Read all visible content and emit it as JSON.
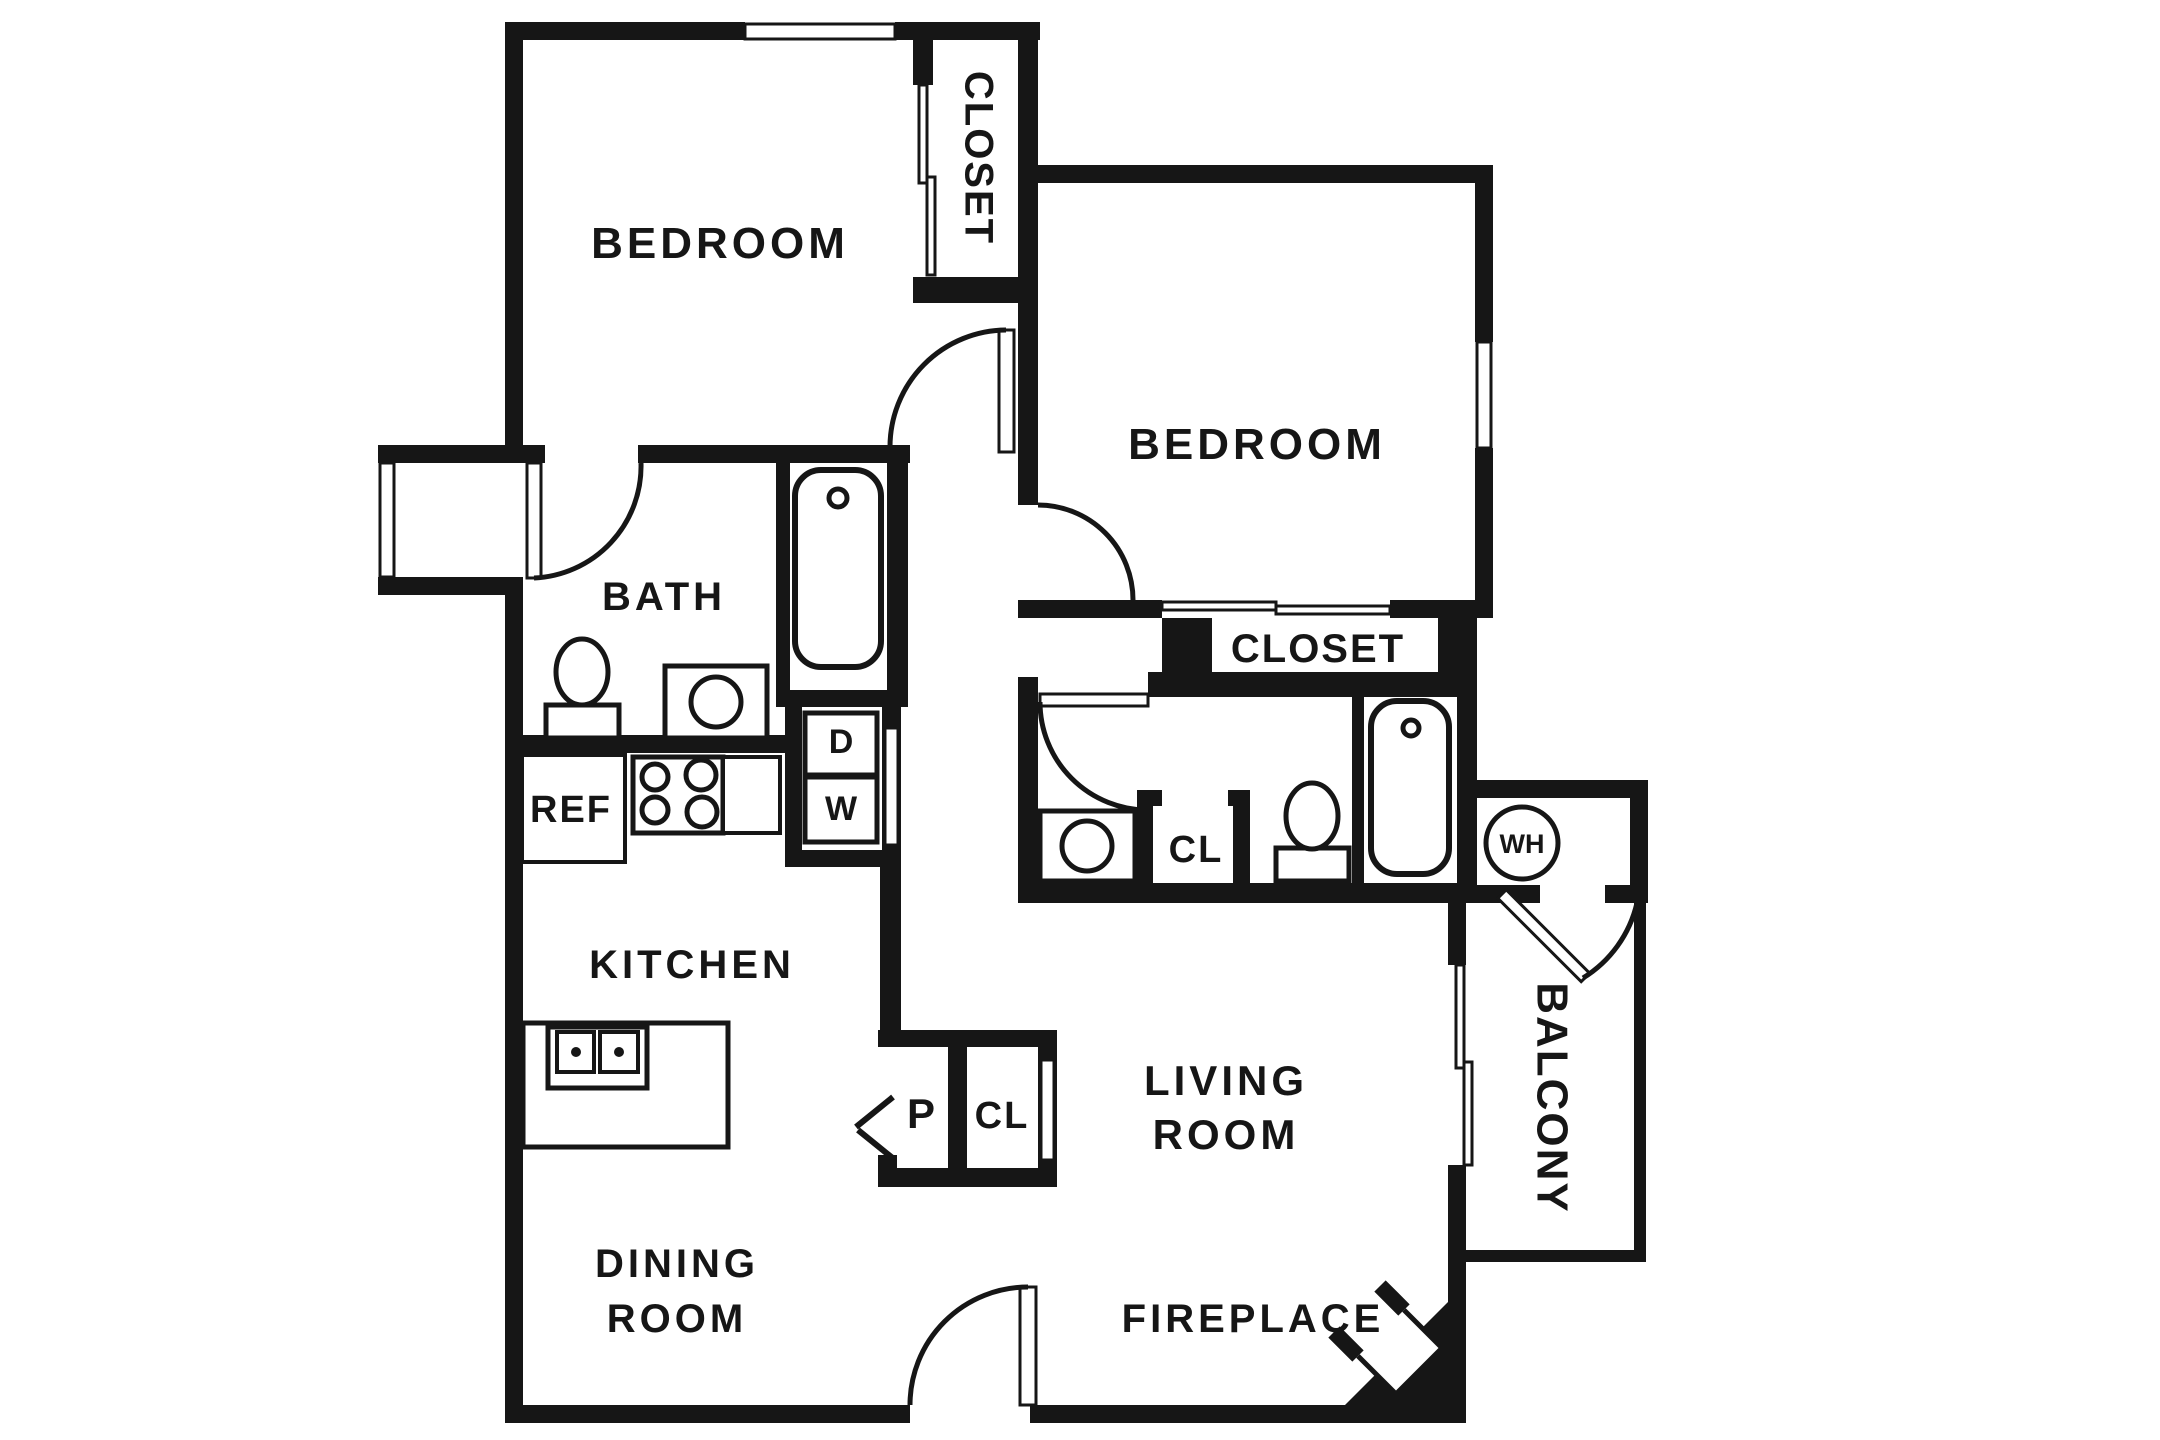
{
  "labels": {
    "bedroom1": "BEDROOM",
    "bedroom1_closet": "CLOSET",
    "bath1": "BATH",
    "refrigerator": "REF",
    "dryer": "D",
    "washer": "W",
    "kitchen": "KITCHEN",
    "dining_room_line1": "DINING",
    "dining_room_line2": "ROOM",
    "bedroom2": "BEDROOM",
    "bedroom2_closet": "CLOSET",
    "bath2_closet": "CL",
    "pantry": "P",
    "hall_closet": "CL",
    "water_heater": "WH",
    "living_room_line1": "LIVING",
    "living_room_line2": "ROOM",
    "balcony": "BALCONY",
    "fireplace": "FIREPLACE"
  },
  "colors": {
    "ink": "#161616",
    "background": "#ffffff"
  }
}
